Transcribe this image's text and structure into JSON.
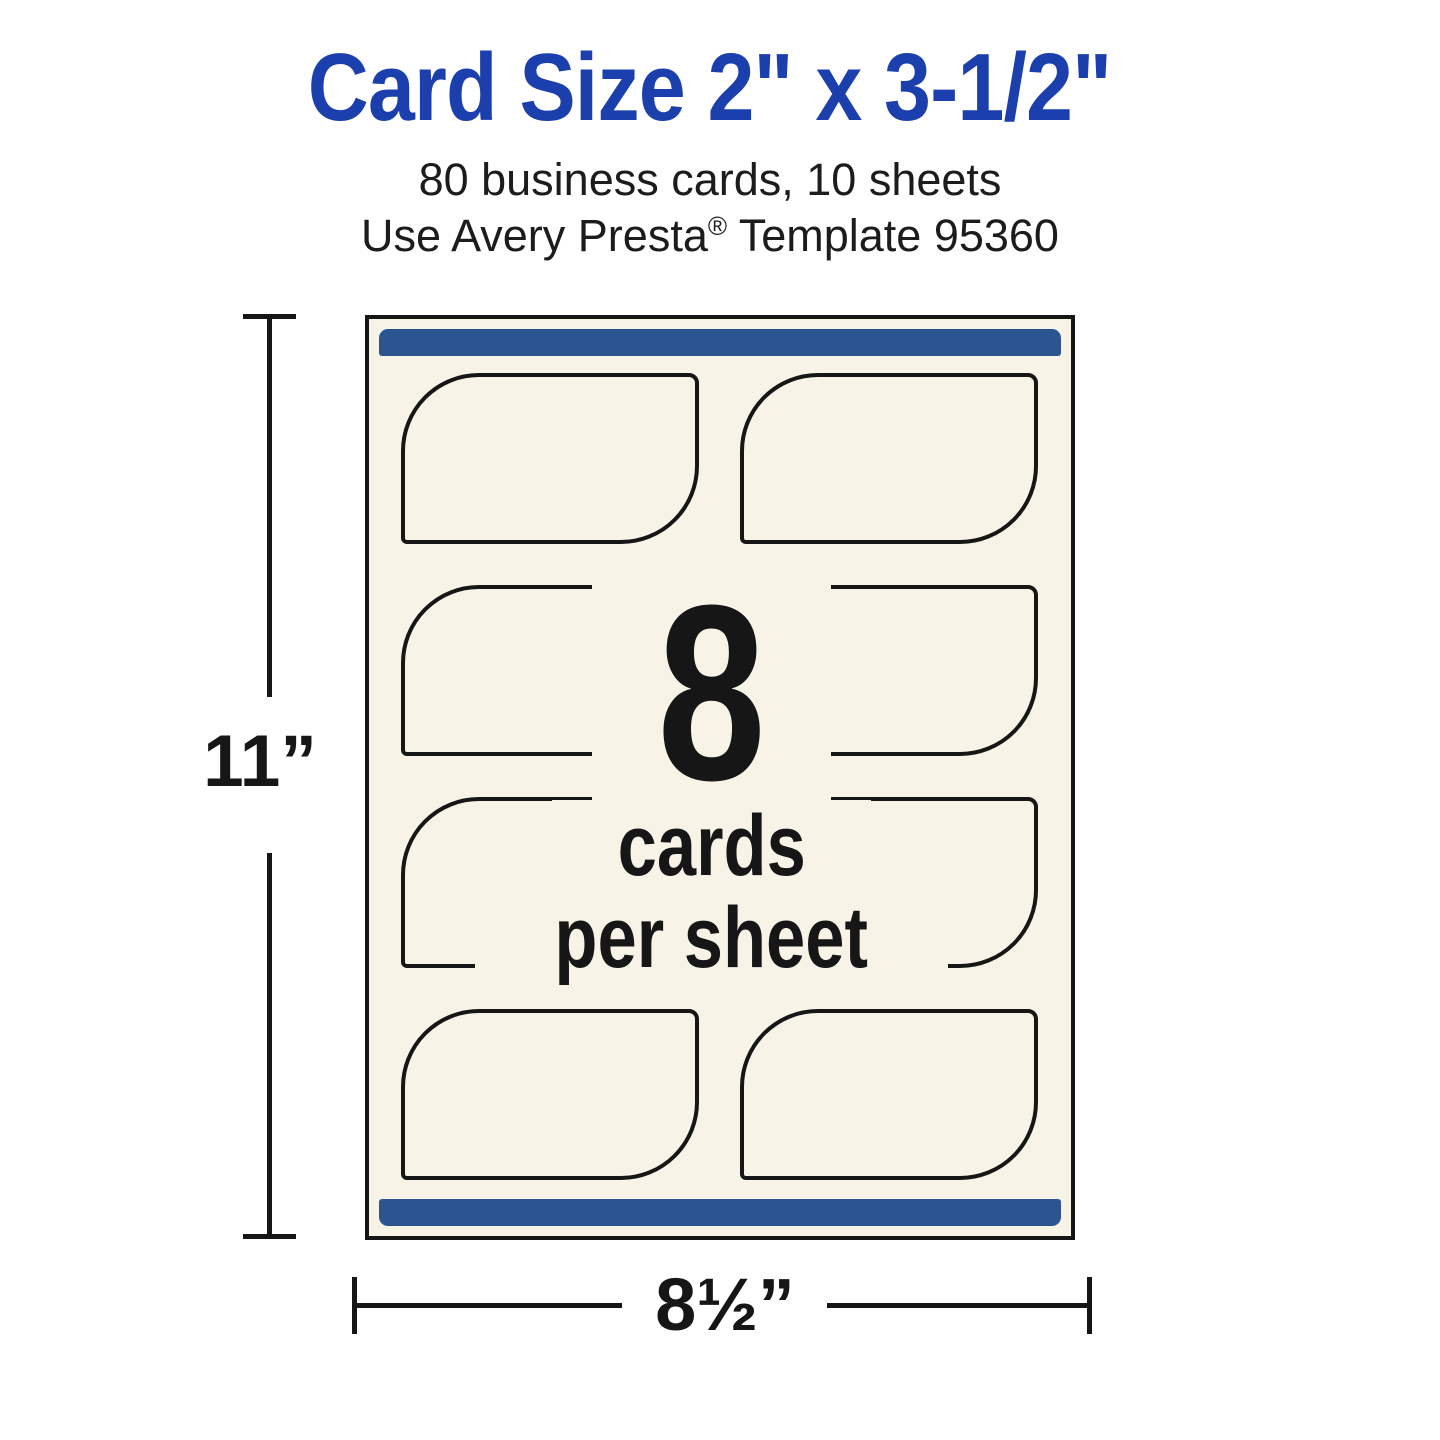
{
  "header": {
    "title": "Card Size 2\" x 3-1/2\"",
    "subtitle_line1": "80 business cards, 10 sheets",
    "subtitle_line2_before": "Use Avery Presta",
    "subtitle_line2_reg": "®",
    "subtitle_line2_after": " Template 95360"
  },
  "sheet": {
    "cards_per_sheet_number": "8",
    "cards_per_sheet_word1": "cards",
    "cards_per_sheet_word2": "per sheet",
    "card_count": 8,
    "card_shape": "rounded top-left and bottom-right corners"
  },
  "dimensions": {
    "height_label": "11”",
    "width_label": "8½”"
  },
  "colors": {
    "title_blue": "#1c3fae",
    "bar_blue": "#2b5591",
    "paper_cream": "#f7f4e7",
    "ink": "#161616"
  }
}
